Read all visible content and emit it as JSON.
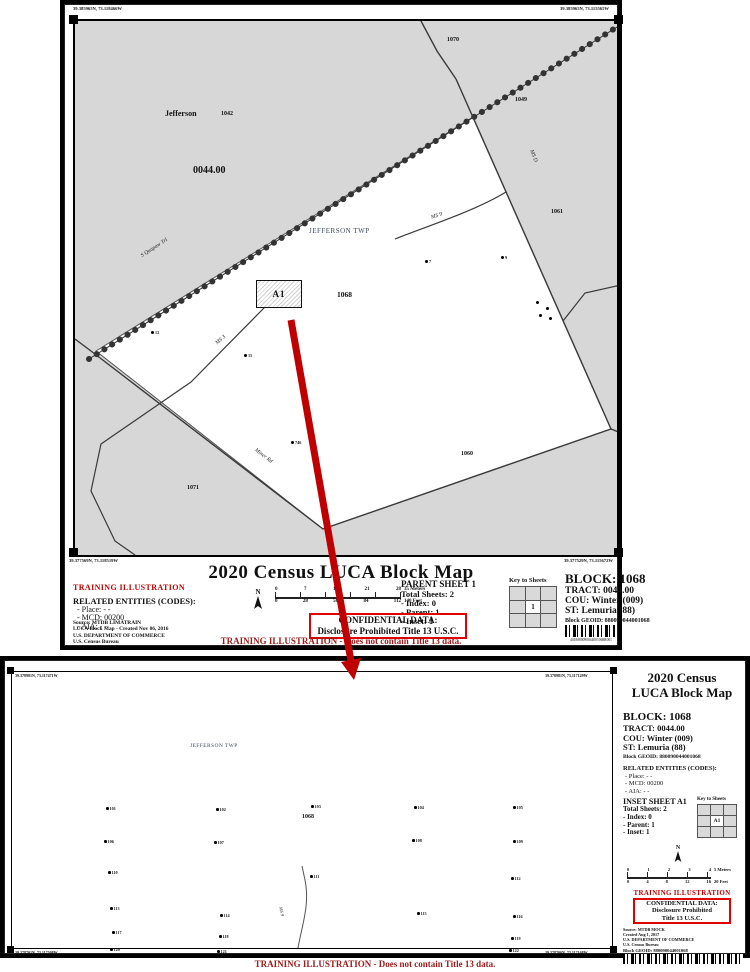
{
  "top_sheet": {
    "coords": {
      "tl": "39.385965N, 73.118466W",
      "tr": "39.385965N, 73.115565W",
      "bl": "39.377569N, 73.118519W",
      "br": "39.377529N, 73.115672W"
    },
    "map": {
      "labels": {
        "county": "Jefferson",
        "block_1042": "1042",
        "tract": "0044.00",
        "block_1070": "1070",
        "block_1049": "1049",
        "township": "JEFFERSON TWP",
        "block_1061": "1061",
        "block_1068": "1068",
        "inset_box": "A1",
        "block_1071": "1071",
        "block_1060": "1060"
      },
      "road_labels": {
        "chain": "S Quapaw Trl",
        "ms9": "MS 9",
        "msd": "MS D",
        "ms3": "MS 3",
        "miner": "Miner Rd"
      },
      "spots": [
        {
          "x": 360,
          "y": 247,
          "label": "7"
        },
        {
          "x": 436,
          "y": 243,
          "label": "9"
        },
        {
          "x": 86,
          "y": 318,
          "label": "12"
        },
        {
          "x": 179,
          "y": 341,
          "label": "15"
        },
        {
          "x": 226,
          "y": 428,
          "label": "746"
        },
        {
          "x": 471,
          "y": 288,
          "label": ""
        },
        {
          "x": 481,
          "y": 294,
          "label": ""
        },
        {
          "x": 474,
          "y": 301,
          "label": ""
        },
        {
          "x": 484,
          "y": 304,
          "label": ""
        }
      ]
    },
    "title": "2020 Census LUCA Block Map",
    "training": "TRAINING ILLUSTRATION",
    "related": {
      "heading": "RELATED ENTITIES (CODES):",
      "items": [
        "- Place: - -",
        "- MCD: 00200",
        "- AIA: - -"
      ]
    },
    "source_lines": [
      "Source: MTDB LIMATRAIN",
      "LUCA Block Map - Created Nov 06, 2016",
      "U.S. DEPARTMENT OF COMMERCE",
      "U.S. Census Bureau"
    ],
    "north": "N",
    "scale": {
      "meters_ticks": [
        "0",
        "7",
        "14",
        "21",
        "28"
      ],
      "meters_end": "35 Meters",
      "feet_ticks": [
        "0",
        "28",
        "56",
        "84",
        "112"
      ],
      "feet_end": "140 Feet"
    },
    "sheet_info": {
      "heading": "PARENT SHEET 1",
      "lines": [
        "Total Sheets: 2",
        "- Index: 0",
        "- Parent: 1",
        "- Inset: 1"
      ]
    },
    "key": {
      "caption": "Key to Sheets",
      "cells": [
        "",
        "",
        "",
        "",
        "1",
        "",
        "",
        "",
        ""
      ]
    },
    "block_info": {
      "block": "BLOCK: 1068",
      "lines": [
        "TRACT: 0044.00",
        "COU: Winter (009)",
        "ST: Lemuria (88)"
      ],
      "geoid": "Block GEOID: 880090044001068",
      "barcode_caption": "4018880090044001068R001"
    },
    "confidential": {
      "line1": "CONFIDENTIAL DATA:",
      "line2": "Disclosure Prohibited Title 13 U.S.C."
    },
    "footer": "TRAINING ILLUSTRATION - Does not contain Title 13 data."
  },
  "bottom_sheet": {
    "coords": {
      "tl": "39.378981N, 73.117471W",
      "tr": "39.378981N, 73.117129W",
      "bl": "39.378701N, 73.117508W",
      "br": "39.378706N, 73.117168W"
    },
    "map": {
      "township": "JEFFERSON TWP",
      "block": "1068",
      "road": "MS 9",
      "spots": [
        {
          "x": 101,
          "y": 138,
          "label": "101"
        },
        {
          "x": 211,
          "y": 139,
          "label": "102"
        },
        {
          "x": 306,
          "y": 136,
          "label": "103"
        },
        {
          "x": 409,
          "y": 137,
          "label": "104"
        },
        {
          "x": 508,
          "y": 137,
          "label": "105"
        },
        {
          "x": 99,
          "y": 171,
          "label": "106"
        },
        {
          "x": 209,
          "y": 172,
          "label": "107"
        },
        {
          "x": 407,
          "y": 170,
          "label": "108"
        },
        {
          "x": 508,
          "y": 171,
          "label": "109"
        },
        {
          "x": 103,
          "y": 202,
          "label": "110"
        },
        {
          "x": 305,
          "y": 206,
          "label": "111"
        },
        {
          "x": 506,
          "y": 208,
          "label": "112"
        },
        {
          "x": 105,
          "y": 238,
          "label": "113"
        },
        {
          "x": 215,
          "y": 245,
          "label": "114"
        },
        {
          "x": 412,
          "y": 243,
          "label": "115"
        },
        {
          "x": 508,
          "y": 246,
          "label": "116"
        },
        {
          "x": 107,
          "y": 262,
          "label": "117"
        },
        {
          "x": 214,
          "y": 266,
          "label": "118"
        },
        {
          "x": 506,
          "y": 268,
          "label": "119"
        },
        {
          "x": 105,
          "y": 279,
          "label": "120"
        },
        {
          "x": 212,
          "y": 281,
          "label": "121"
        },
        {
          "x": 504,
          "y": 280,
          "label": "122"
        }
      ]
    },
    "panel": {
      "title1": "2020 Census",
      "title2": "LUCA Block Map",
      "block": "BLOCK: 1068",
      "lines": [
        "TRACT: 0044.00",
        "COU: Winter (009)",
        "ST: Lemuria (88)"
      ],
      "geoid": "Block GEOID: 880090044001068",
      "related": {
        "heading": "RELATED ENTITIES (CODES):",
        "items": [
          "- Place: - -",
          "- MCD: 00200",
          "- AIA: - -"
        ]
      },
      "sheet_info": {
        "heading": "INSET SHEET A1",
        "lines": [
          "Total Sheets: 2",
          "- Index: 0",
          "- Parent: 1",
          "- Inset: 1"
        ]
      },
      "key": {
        "caption": "Key to Sheets",
        "cells": [
          "",
          "",
          "",
          "",
          "A1",
          "",
          "",
          "",
          ""
        ]
      },
      "north": "N",
      "scale": {
        "meters_ticks": [
          "0",
          "1",
          "2",
          "3",
          "4"
        ],
        "meters_end": "5 Meters",
        "feet_ticks": [
          "0",
          "4",
          "8",
          "12",
          "16"
        ],
        "feet_end": "20 Feet"
      },
      "training": "TRAINING ILLUSTRATION",
      "confidential": [
        "CONFIDENTIAL DATA:",
        "Disclosure Prohibited",
        "Title 13 U.S.C."
      ],
      "source_lines": [
        "Source: MTDB MOCK",
        "Created Aug 1, 2017",
        "U.S. DEPARTMENT OF COMMERCE",
        "U.S. Census Bureau"
      ],
      "geoid2": "Block GEOID: 880090044001068"
    },
    "footer": "TRAINING ILLUSTRATION - Does not contain Title 13 data."
  }
}
